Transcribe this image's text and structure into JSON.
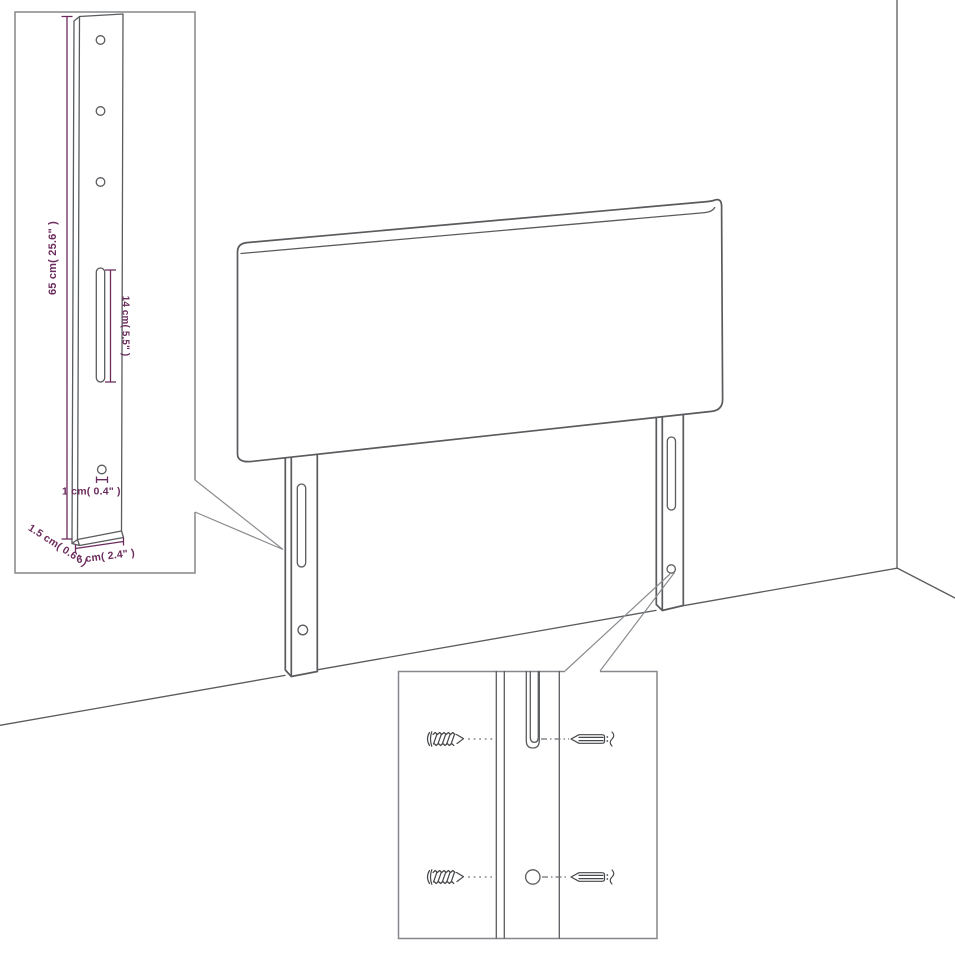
{
  "diagram": {
    "kind": "headboard-assembly-dimension-diagram",
    "colors": {
      "line": "#595b5e",
      "accent": "#6b2b5c",
      "background": "#ffffff"
    },
    "strut_inset": {
      "height_label": "65 cm( 25.6\" )",
      "slot_label": "14 cm( 5.5\" )",
      "hole_label": "1 cm( 0.4\" )",
      "depth_label": "1.5 cm( 0.6\" )",
      "width_label": "6 cm( 2.4\" )"
    },
    "hardware_inset": {
      "parts": [
        "screw",
        "wall plug"
      ]
    }
  }
}
